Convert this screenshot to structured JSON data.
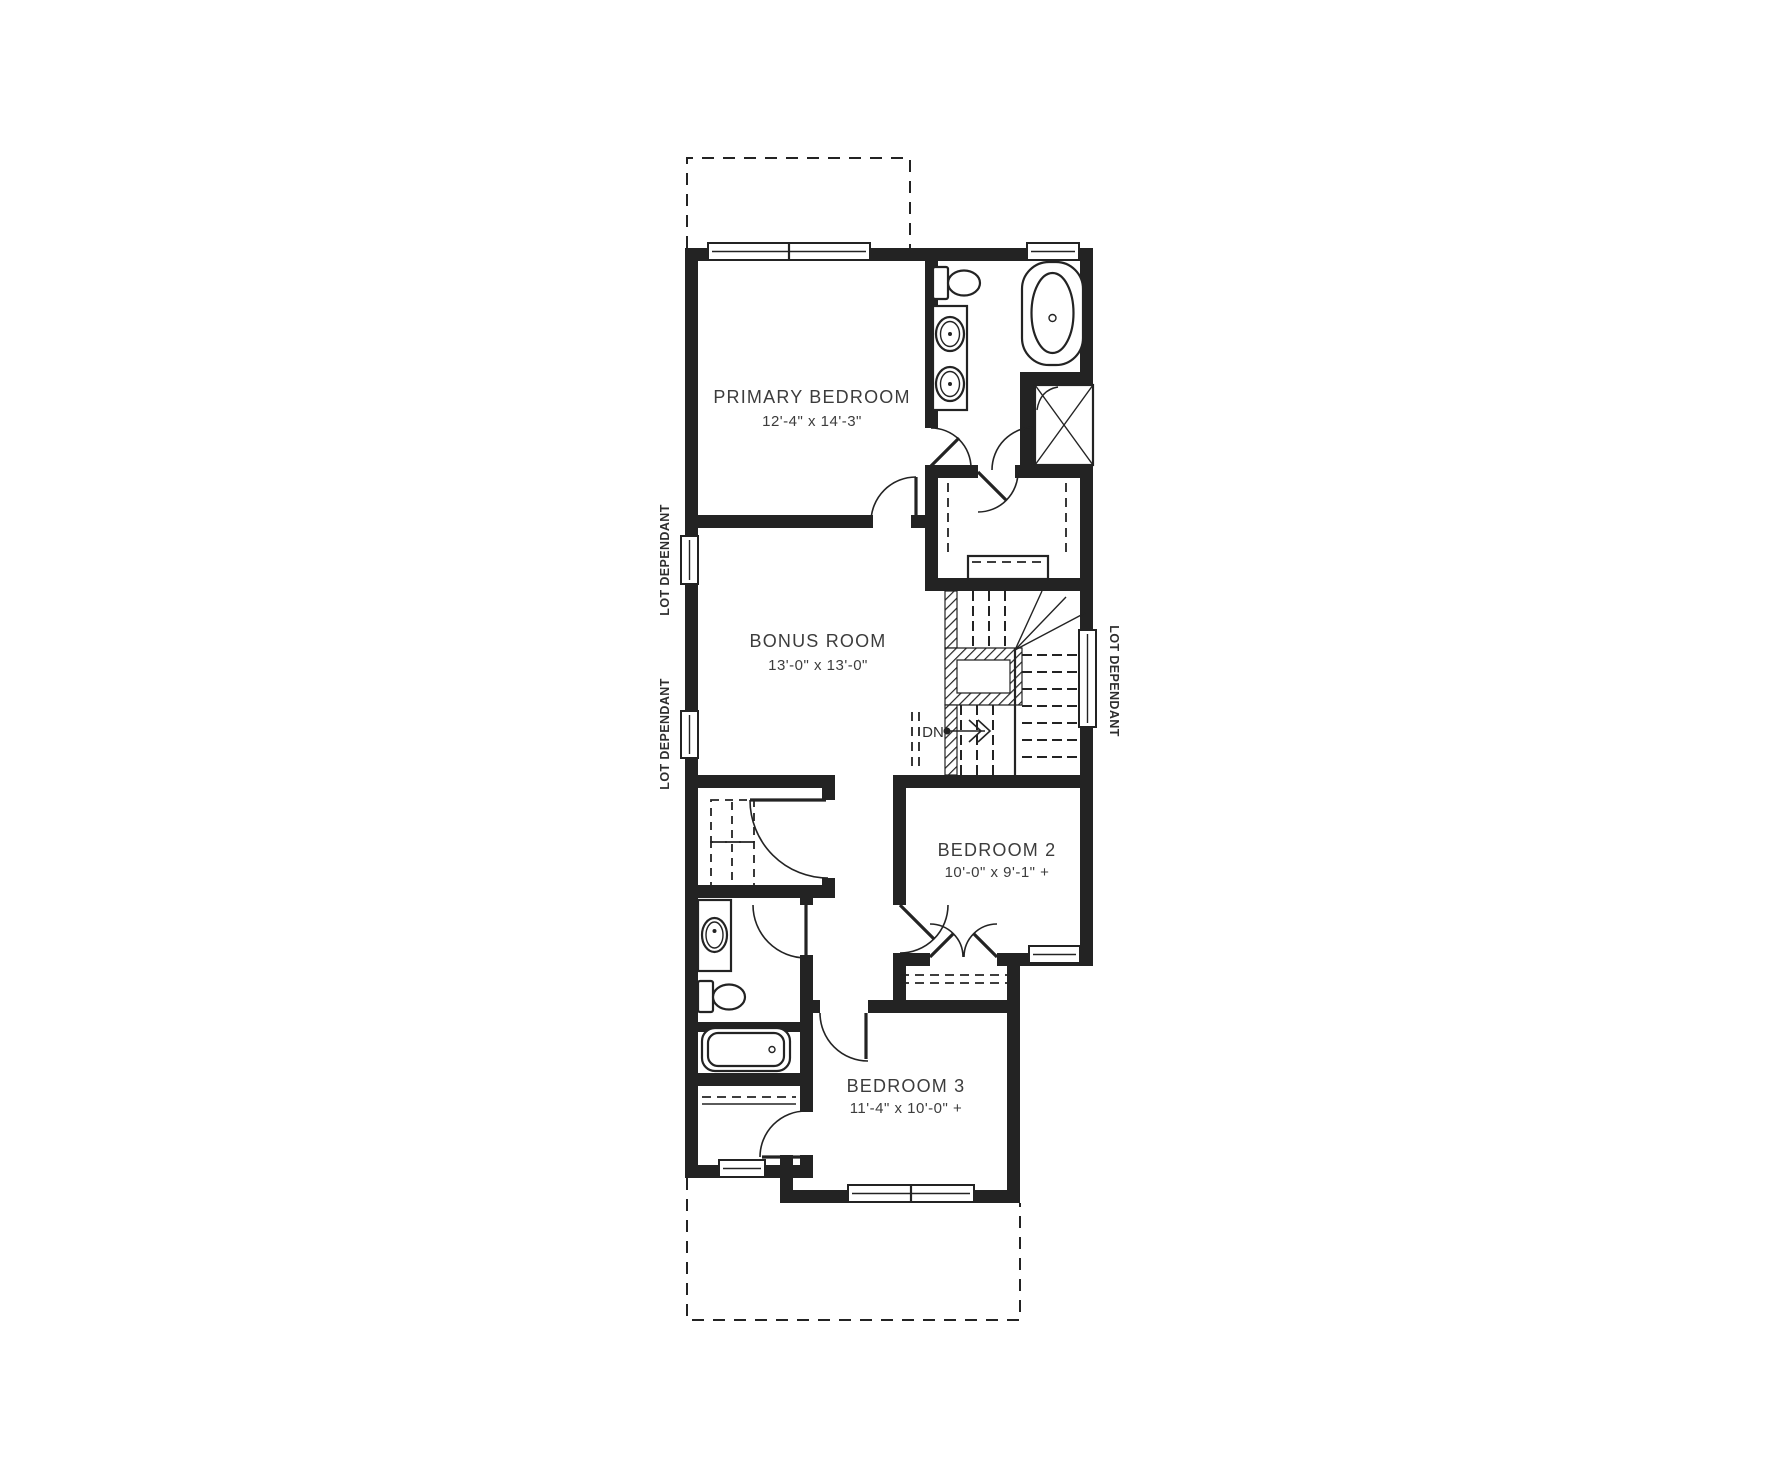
{
  "plan": {
    "type": "residential-second-floor-plan",
    "background": "#ffffff",
    "wall_color": "#232323",
    "text_color": "#3c3c3c"
  },
  "rooms": [
    {
      "name": "PRIMARY BEDROOM",
      "dimensions": "12'-4\" x 14'-3\""
    },
    {
      "name": "BONUS ROOM",
      "dimensions": "13'-0\" x 13'-0\""
    },
    {
      "name": "BEDROOM 2",
      "dimensions": "10'-0\" x 9'-1\" +"
    },
    {
      "name": "BEDROOM  3",
      "dimensions": "11'-4\" x 10'-0\" +"
    }
  ],
  "annotations": {
    "stair_direction": "DN",
    "lot_dependant": [
      "LOT DEPENDANT",
      "LOT DEPENDANT",
      "LOT DEPENDANT"
    ]
  },
  "fixtures": {
    "ensuite": [
      "toilet",
      "double-vanity-sinks",
      "freestanding-tub",
      "shower"
    ],
    "main_bath": [
      "vanity-sink",
      "toilet",
      "bathtub"
    ],
    "laundry": [
      "washer-dryer-dashed"
    ],
    "closets": [
      "walk-in-closet-rods-shelf",
      "bedroom2-closet-rod",
      "bedroom3-closet-shelf"
    ],
    "stairs": [
      "winder-staircase-open-well"
    ]
  },
  "windows_count": 8,
  "dashed_outline_areas": 2
}
